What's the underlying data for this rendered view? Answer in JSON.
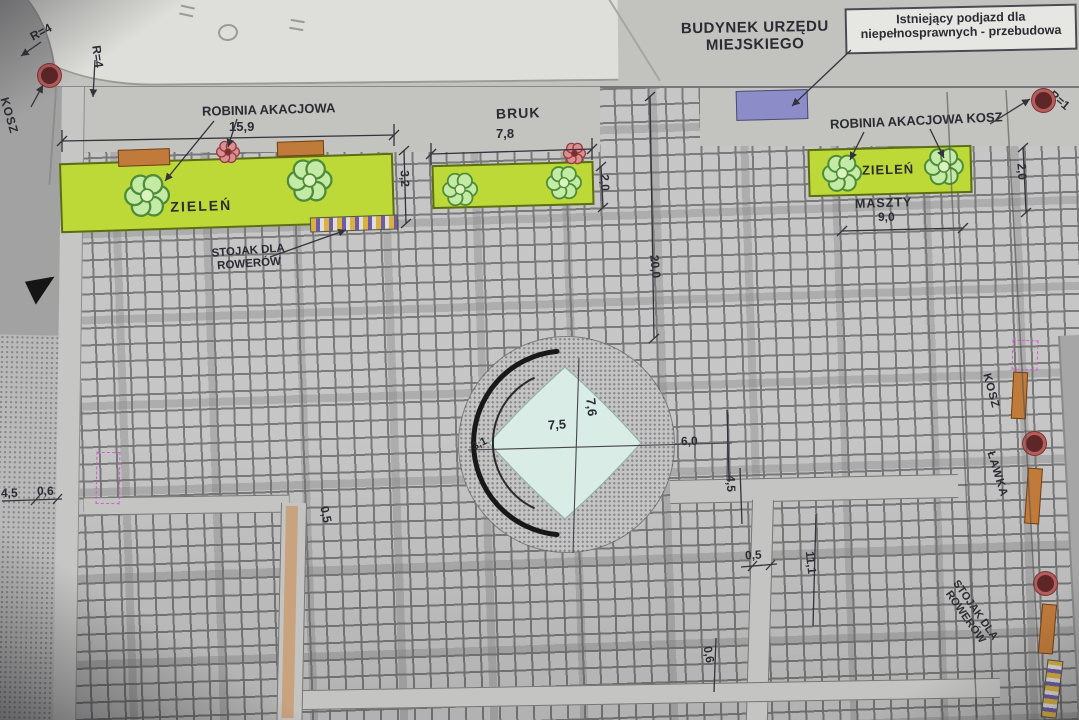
{
  "colors": {
    "greenery": "#bcd938",
    "water": "#d9ece5",
    "bench_wood": "#c07b3b",
    "ramp_blue": "#8c8cc9",
    "tree_red": "#c96a6a",
    "shrub_green": "#c4eba6",
    "pink_marker": "#c95fc9"
  },
  "icons": {
    "shrub-icon": "green six-petal flower symbol",
    "tree-icon": "red flower symbol (robinia tree)",
    "trash-bin-icon": "red ring circle",
    "bike-rack": "striped bar",
    "bench": "orange rectangle"
  },
  "labels": {
    "building": [
      "BUDYNEK URZĘDU",
      "MIEJSKIEGO"
    ],
    "ramp_note": [
      "Istniejący podjazd dla",
      "niepełnosprawnych - przebudowa"
    ],
    "tree_row_left": "ROBINIA AKACJOWA",
    "tree_row_right": "ROBINIA AKACJOWA KOSZ",
    "greenery_left": "ZIELEŃ",
    "greenery_right": "ZIELEŃ",
    "pavement": "BRUK",
    "masts": "MASZTY",
    "bike_rack_left": [
      "STOJAK DLA",
      "ROWERÓW"
    ],
    "bike_rack_right": [
      "STOJAK DLA",
      "ROWERÓW"
    ],
    "bin_left": "KOSZ",
    "bin_right": "KOSZ",
    "bench": "ŁAWKA"
  },
  "dimensions": {
    "tree_row_length": "15,9",
    "green_left_width": "3,2",
    "pavement_length": "7,8",
    "pavement_width": "2,0",
    "green_right_width": "2,0",
    "masts_spacing": "9,0",
    "plaza_depth": "20,0",
    "fountain_width": "7,5",
    "fountain_height": "7,6",
    "fountain_radius": "3,1",
    "east_gap": "6,0",
    "east_path_width": "4,5",
    "east_edge": "0,5",
    "east_length": "11,1",
    "east_bottom": "0,6",
    "west_path_edge": "0,5",
    "west_walk_a": "4,5",
    "west_walk_b": "0,6",
    "curb_radius_a": "R=4",
    "curb_radius_b": "R=4",
    "curb_radius_right": "R=1"
  }
}
